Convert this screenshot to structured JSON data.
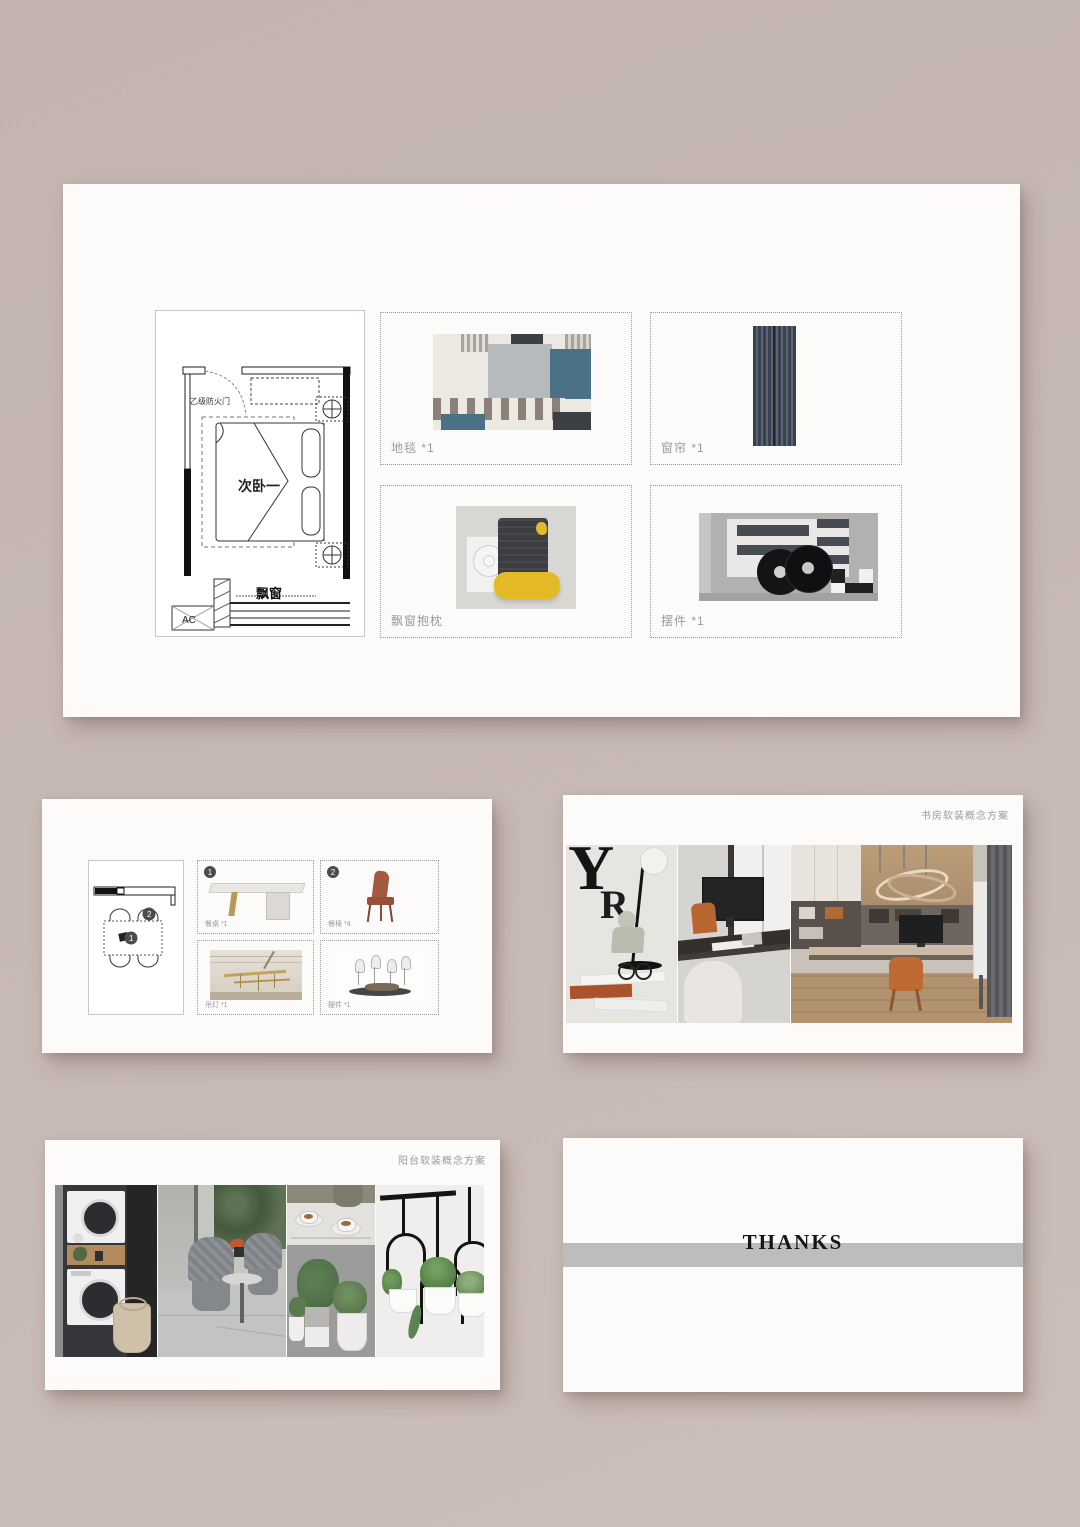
{
  "colors": {
    "backdrop": "#c5b7b2",
    "slide": "#fcfbfa",
    "label_gray": "#9a9a9a",
    "band_gray": "#bdbdbd",
    "carpet_teal": "#4a7185",
    "pillow_yellow": "#e2b928",
    "chair_orange": "#b4593a"
  },
  "bedroom_slide": {
    "floorplan": {
      "door_label": "乙级防火门",
      "room_label": "次卧一",
      "bay_window_label": "飘窗",
      "ac_label": "AC"
    },
    "items": [
      {
        "label": "地毯 *1"
      },
      {
        "label": "窗帘 *1"
      },
      {
        "label": "飘窗抱枕"
      },
      {
        "label": "摆件 *1"
      }
    ]
  },
  "dining_slide": {
    "plan_badges": [
      "1",
      "2"
    ],
    "items": [
      {
        "badge": "1",
        "label": "餐桌 *1"
      },
      {
        "badge": "2",
        "label": "餐椅 *4"
      },
      {
        "badge": "",
        "label": "吊灯 *1"
      },
      {
        "badge": "",
        "label": "摆件 *1"
      }
    ]
  },
  "study_slide": {
    "title": "书房软装概念方案"
  },
  "balcony_slide": {
    "title": "阳台软装概念方案"
  },
  "thanks_slide": {
    "title": "THANKS"
  }
}
